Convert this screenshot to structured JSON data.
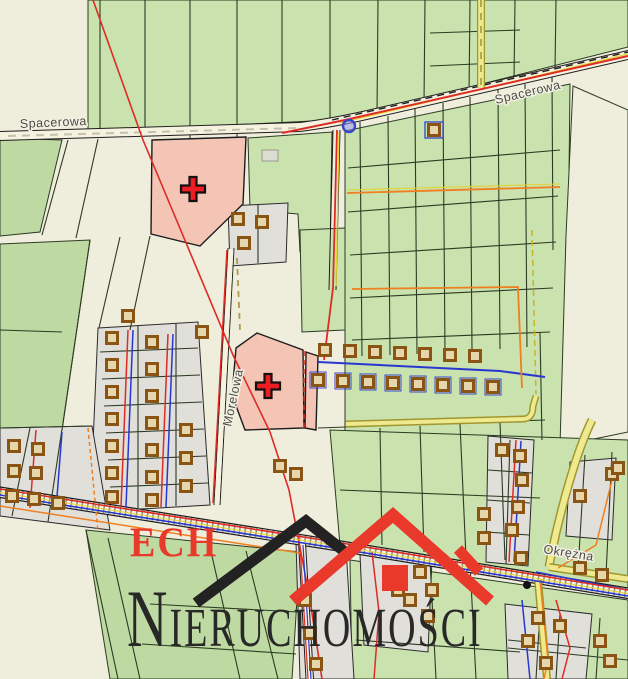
{
  "watermark": {
    "company_initials": "ECH",
    "company_name": "NIERUCHOMOŚCI"
  },
  "map": {
    "street_labels": [
      {
        "id": "spacerowa-west",
        "text": "Spacerowa"
      },
      {
        "id": "spacerowa-east",
        "text": "Spacerowa"
      },
      {
        "id": "morelowa",
        "text": "Morelowa"
      },
      {
        "id": "okrezna",
        "text": "Okrężna"
      }
    ],
    "markers": [
      {
        "id": "highlighted-parcel-1",
        "symbol": "red-cross-icon"
      },
      {
        "id": "highlighted-parcel-2",
        "symbol": "red-cross-icon"
      }
    ]
  },
  "colors": {
    "cream": "#efeddc",
    "green": "#c9e2ae",
    "green2": "#bedaa2",
    "gray": "#e0dfda",
    "pink": "#f4c5b4",
    "road": "#f5f2df",
    "boundary": "#2c3b23",
    "red": "#df2b26",
    "markerRed": "#ee1c23",
    "blue": "#2837cf",
    "orange": "#ef7f1f",
    "yellowRoad": "#efe98f",
    "yellowEdge": "#a0982f",
    "yellowLine": "#e3d435",
    "brown": "#8a5414",
    "bldFill": "#e5d6ab",
    "labelFill": "#4b4b4b",
    "halo": "#f2f0e0",
    "wmRed": "#e8392b",
    "wmBlack": "#282828"
  }
}
